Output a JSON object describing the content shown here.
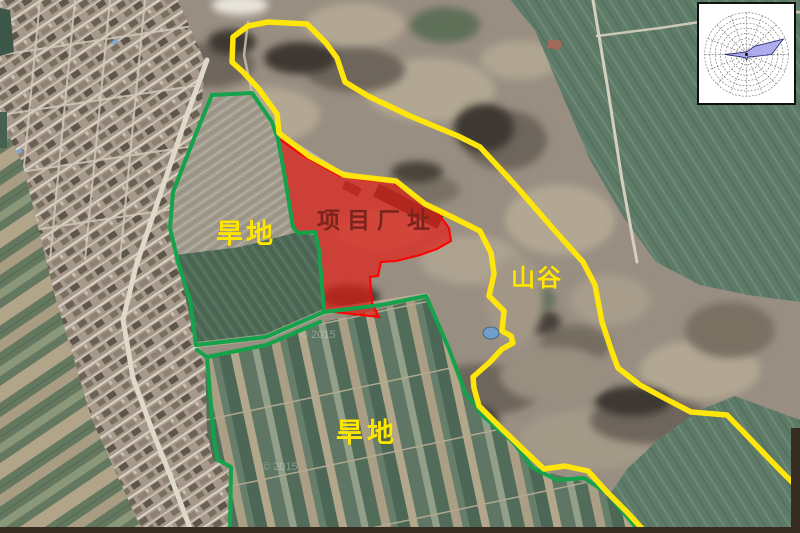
{
  "figure": {
    "type": "annotated satellite map of project site",
    "description": "Satellite image with project plant-site polygon, land-use boundaries and wind rose inset"
  },
  "labels": {
    "project_site": "项目厂址",
    "dryland_upper": "旱地",
    "dryland_lower": "旱地",
    "valley": "山谷"
  },
  "watermark": "© 2015",
  "colors": {
    "project_site_fill": "#e32017",
    "project_site_border": "#ff0000",
    "project_site_text": "#7b241c",
    "boundary_green": "#14a24b",
    "valley_line_yellow": "#ffe60a",
    "field_label_yellow": "#ffe600",
    "wind_rose_fill": "#a6a6ee",
    "wind_rose_outline": "#26266a"
  },
  "wind_rose": {
    "type": "polar wind-direction frequency rose",
    "directions": [
      "N",
      "NNE",
      "NE",
      "ENE",
      "E",
      "ESE",
      "SE",
      "SSE",
      "S",
      "SSW",
      "SW",
      "WSW",
      "W",
      "WNW",
      "NW",
      "NNW"
    ],
    "values_fraction": [
      0.07,
      0.09,
      0.28,
      0.95,
      0.6,
      0.15,
      0.08,
      0.07,
      0.13,
      0.08,
      0.1,
      0.15,
      0.52,
      0.12,
      0.08,
      0.06
    ],
    "polygon_points": "50,49.9 51.5,49.3 58.7,44.3 88.6,37 76.4,53 56.1,55.5 52.5,55.5 51.2,55.9 50,58.7 48.7,56.2 46.9,56.1 43.9,55.5 27.1,53 45.1,51 47.5,50.5 49,50.6"
  }
}
